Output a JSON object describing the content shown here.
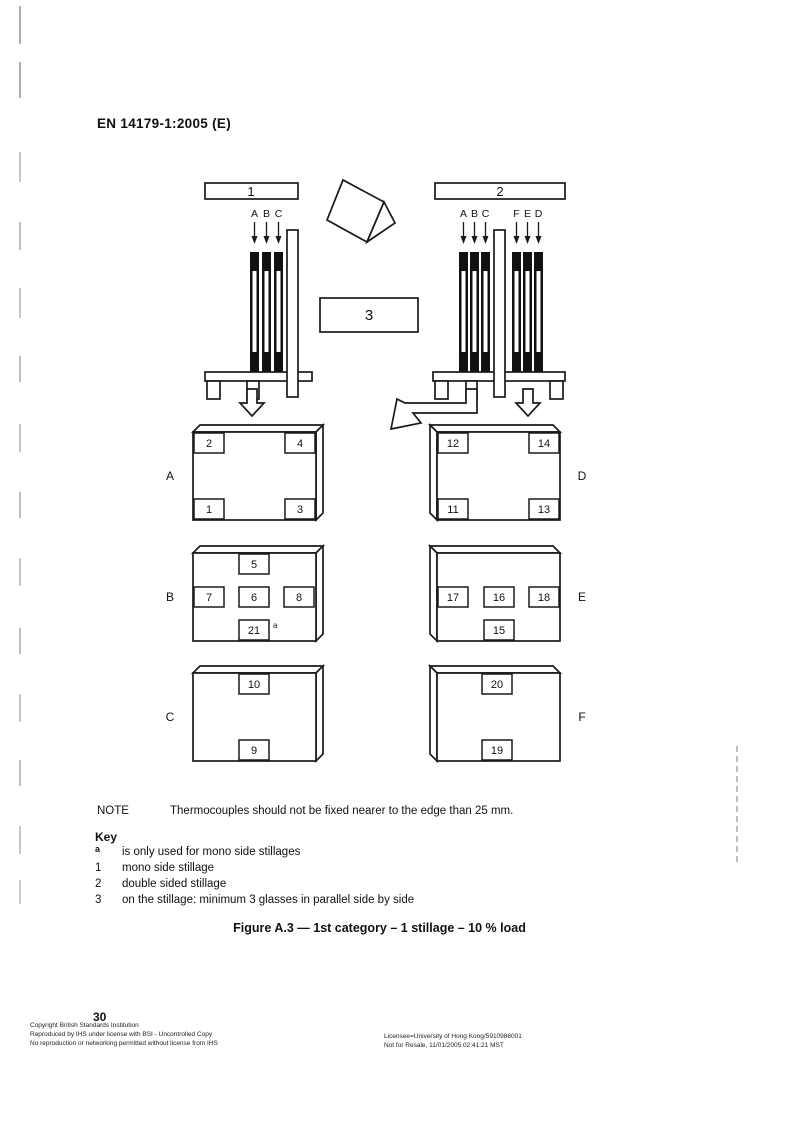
{
  "page": {
    "header": "EN 14179-1:2005 (E)",
    "page_number": "30"
  },
  "diagram": {
    "stillage_1_label": "1",
    "stillage_2_label": "2",
    "glasses_box_label": "3",
    "mono_glass_labels": [
      "A",
      "B",
      "C"
    ],
    "double_glass_labels": [
      "A",
      "B",
      "C",
      "F",
      "E",
      "D"
    ],
    "panels": {
      "A": {
        "letter": "A",
        "boxes": [
          "2",
          "4",
          "1",
          "3"
        ]
      },
      "B": {
        "letter": "B",
        "boxes": [
          "5",
          "7",
          "6",
          "8",
          "21"
        ],
        "footnote_marker": "a"
      },
      "C": {
        "letter": "C",
        "boxes": [
          "10",
          "9"
        ]
      },
      "D": {
        "letter": "D",
        "boxes": [
          "12",
          "14",
          "11",
          "13"
        ]
      },
      "E": {
        "letter": "E",
        "boxes": [
          "17",
          "16",
          "18",
          "15"
        ]
      },
      "F": {
        "letter": "F",
        "boxes": [
          "20",
          "19"
        ]
      }
    }
  },
  "note": {
    "label": "NOTE",
    "text": "Thermocouples should not be fixed nearer to the edge than 25 mm."
  },
  "key": {
    "title": "Key",
    "items": [
      {
        "symbol": "a",
        "text": "is only used for mono side stillages"
      },
      {
        "symbol": "1",
        "text": "mono side stillage"
      },
      {
        "symbol": "2",
        "text": "double sided stillage"
      },
      {
        "symbol": "3",
        "text": "on the stillage: minimum 3 glasses in parallel side by side"
      }
    ]
  },
  "caption": "Figure A.3 — 1st category – 1 stillage – 10 % load",
  "footer": {
    "left_lines": [
      "Copyright British Standards Institution",
      "Reproduced by IHS under license with BSI - Uncontrolled Copy",
      "No reproduction or networking permitted without license from IHS"
    ],
    "right_lines": [
      "Licensee=University of Hong Kong/5910986001",
      "Not for Resale, 11/01/2005 02:41:21 MST"
    ]
  }
}
